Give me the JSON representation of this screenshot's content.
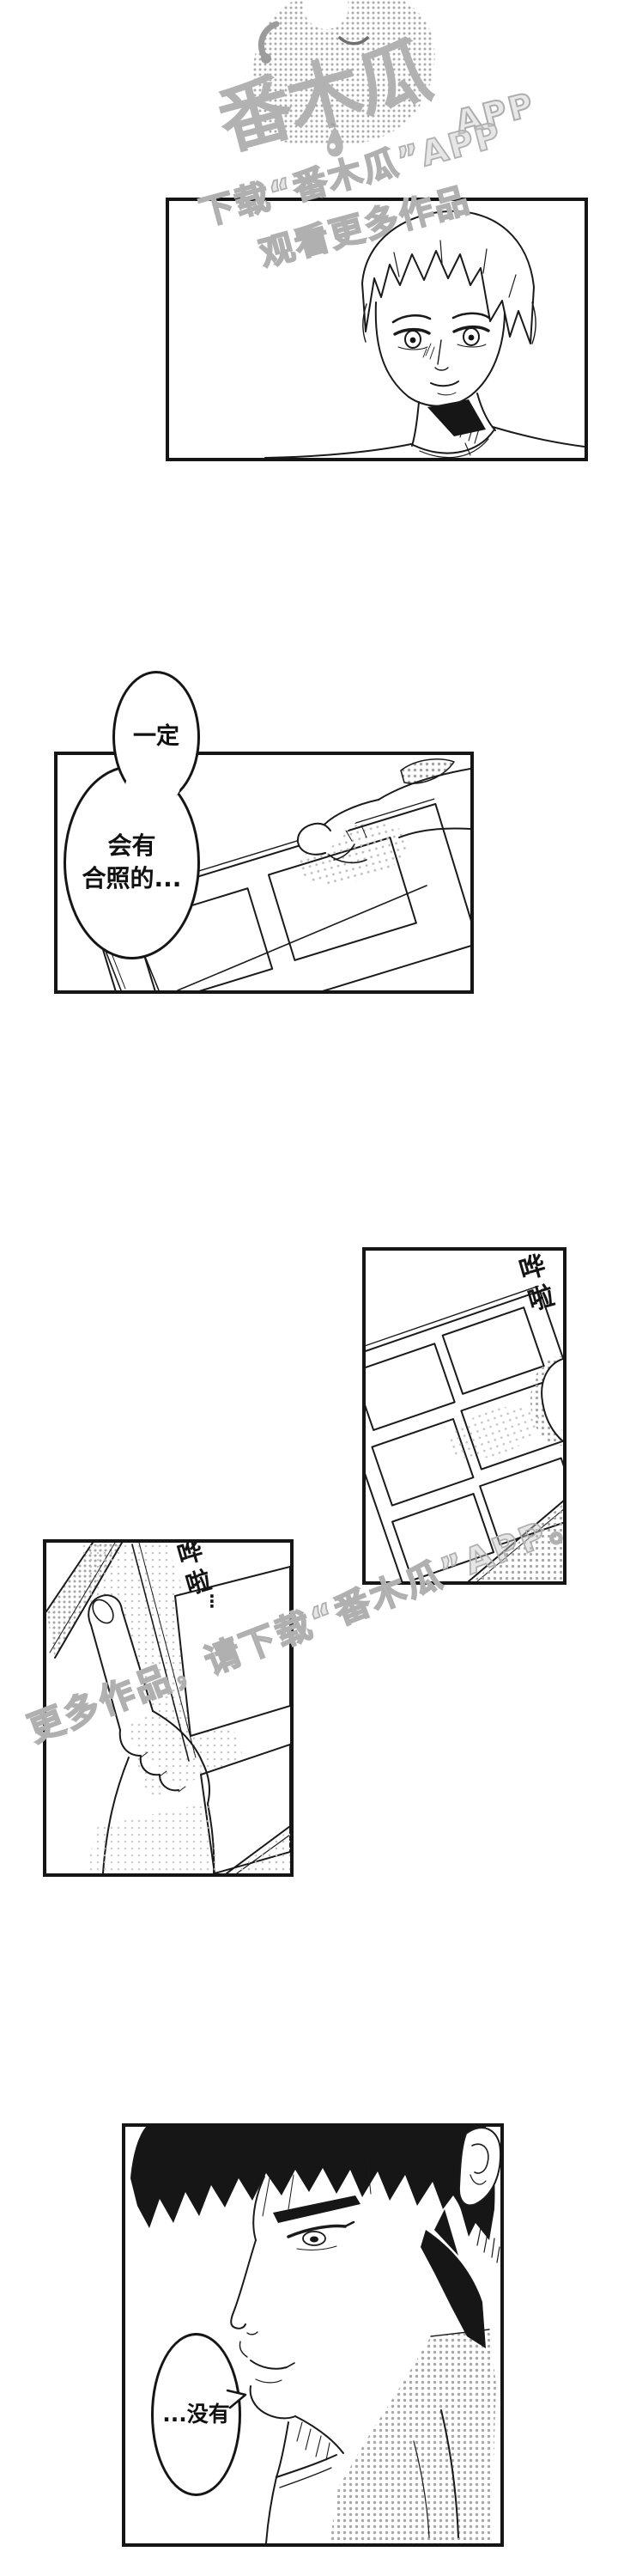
{
  "page": {
    "bg_color": "#ffffff",
    "ink_color": "#1a1a1a",
    "halftone_color": "#a8a8a8",
    "watermark_color": "#b3b3b3"
  },
  "branding": {
    "logo_text": "番木瓜",
    "logo_app_label": "APP"
  },
  "watermarks": {
    "top_line1": "下载“番木瓜”APP",
    "top_line2": "观看更多作品",
    "middle_line": "更多作品，请下载“番木瓜”APP。"
  },
  "dialogue": {
    "bubble_sure": "一定",
    "bubble_album_line1": "会有",
    "bubble_album_line2": "合照的...",
    "bubble_none": "...没有"
  },
  "sfx": {
    "flip_right": "哗啦",
    "flip_left": "哗啦",
    "flip_left_trail": "⋮"
  }
}
